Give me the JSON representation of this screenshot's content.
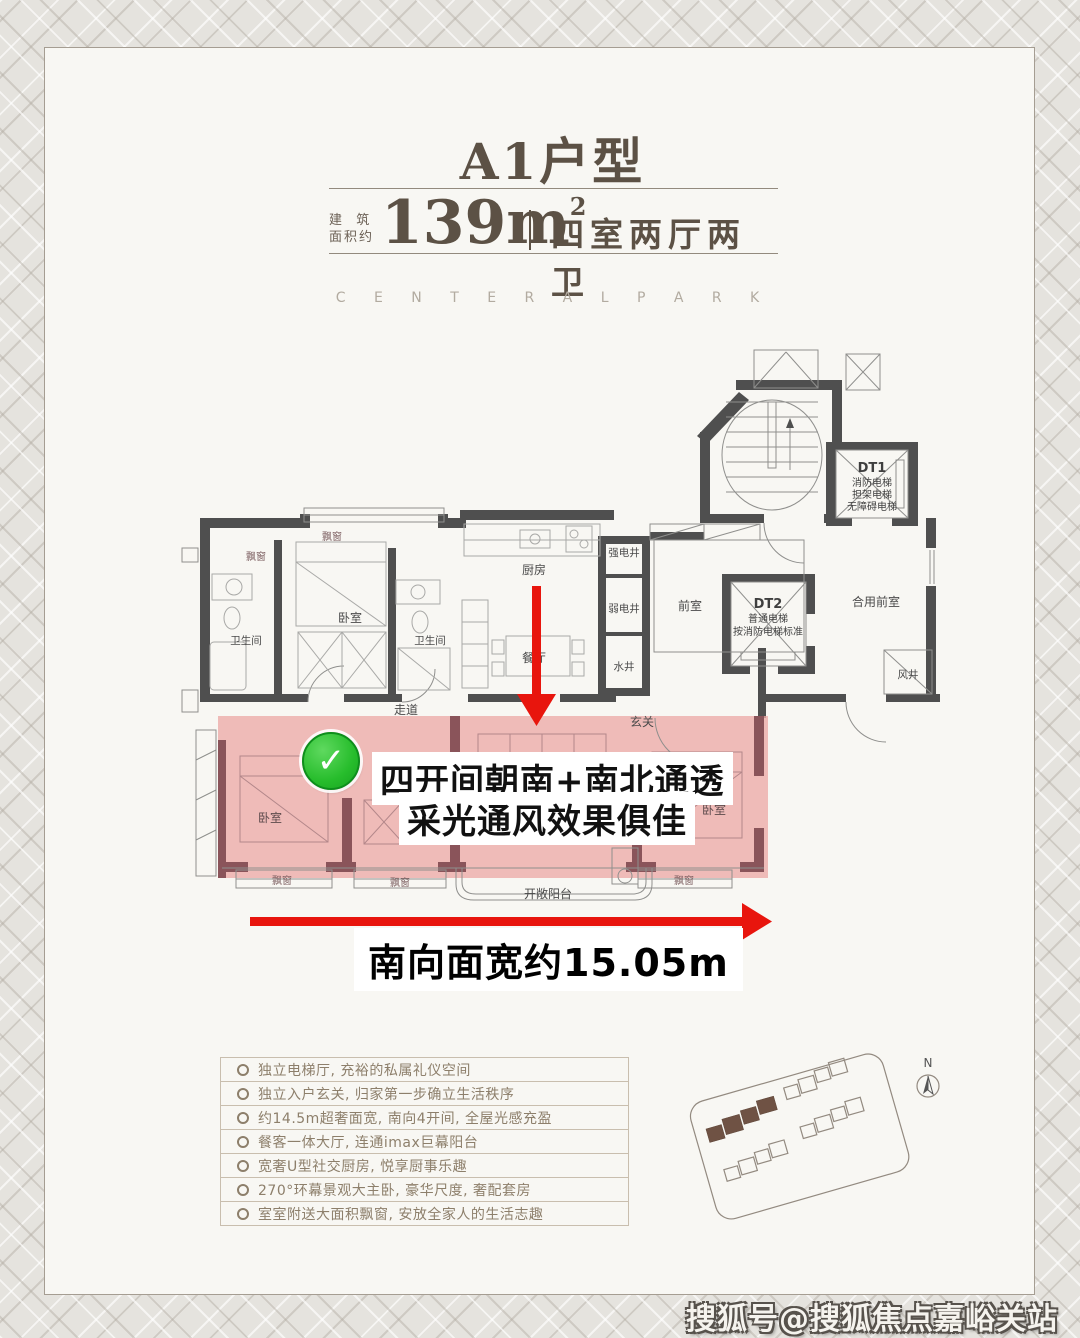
{
  "header": {
    "title": "A1户型",
    "area_label_line1": "建  筑",
    "area_label_line2": "面积约",
    "area_value": "139m",
    "area_exponent": "2",
    "rooms_text": "四室两厅两卫",
    "subtitle": "C E N T E R A L   P A R K"
  },
  "floorplan": {
    "rooms": {
      "bedroom": "卧室",
      "bathroom": "卫生间",
      "bay_window": "飘窗",
      "kitchen": "厨房",
      "dining": "餐厅",
      "corridor": "走道",
      "foyer": "玄关",
      "front_room": "前室",
      "shared_front_room": "合用前室",
      "strong_elec_shaft": "强电井",
      "weak_elec_shaft": "弱电井",
      "water_shaft": "水井",
      "wind_shaft": "风井",
      "open_balcony": "开敞阳台"
    },
    "elevators": {
      "dt1_name": "DT1",
      "dt1_line1": "消防电梯",
      "dt1_line2": "担架电梯",
      "dt1_line3": "无障碍电梯",
      "dt2_name": "DT2",
      "dt2_line1": "普通电梯",
      "dt2_line2": "按消防电梯标准"
    },
    "annotations": {
      "check_icon": "✓",
      "highlight_line1": "四开间朝南+南北通透",
      "highlight_line2": "采光通风效果俱佳",
      "south_width": "南向面宽约15.05m"
    }
  },
  "features": {
    "items": [
      "独立电梯厅, 充裕的私属礼仪空间",
      "独立入户玄关, 归家第一步确立生活秩序",
      "约14.5m超奢面宽, 南向4开间, 全屋光感充盈",
      "餐客一体大厅, 连通imax巨幕阳台",
      "宽奢U型社交厨房, 悦享厨事乐趣",
      "270°环幕景观大主卧, 豪华尺度, 奢配套房",
      "室室附送大面积飘窗, 安放全家人的生活志趣"
    ]
  },
  "sitemap": {
    "north_label": "N"
  },
  "watermark": {
    "text": "搜狐号@搜狐焦点嘉峪关站"
  },
  "colors": {
    "highlight_pink": "#ecaaa6",
    "arrow_red": "#e8150d",
    "check_green": "#27bd2c",
    "title_brown": "#5c5145",
    "feature_text": "#8d7f6b",
    "wall_dark": "#4f4f4f",
    "wall_pink_zone": "#8a545a"
  }
}
